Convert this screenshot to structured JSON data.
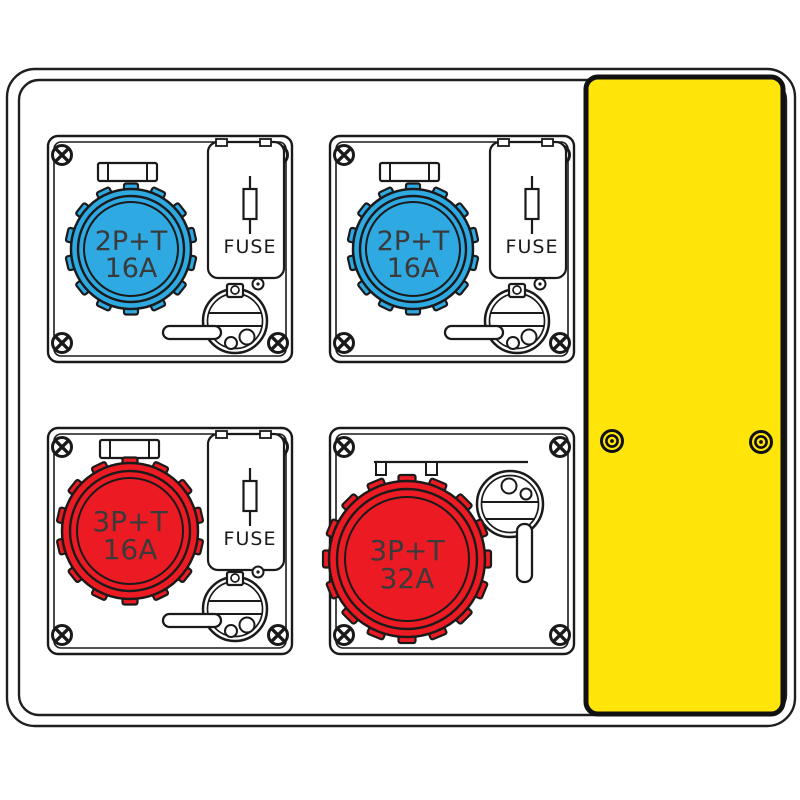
{
  "board": {
    "description": "distribution-board-technical-drawing",
    "line_color": "#1a1a1a",
    "label_color": "#3a3a3a",
    "side_panel": {
      "color": "#ffe50a",
      "fastener_icon": "concentric-rivet",
      "fastener_count": 2
    }
  },
  "modules": [
    {
      "position": "top-left",
      "socket": {
        "line1": "2P+T",
        "line2": "16A",
        "color": "#2fa9e1",
        "icon": "cee-socket-blue-16a"
      },
      "fuse_label": "FUSE",
      "has_interlock": true
    },
    {
      "position": "top-right",
      "socket": {
        "line1": "2P+T",
        "line2": "16A",
        "color": "#2fa9e1",
        "icon": "cee-socket-blue-16a"
      },
      "fuse_label": "FUSE",
      "has_interlock": true
    },
    {
      "position": "bottom-left",
      "socket": {
        "line1": "3P+T",
        "line2": "16A",
        "color": "#ec1b23",
        "icon": "cee-socket-red-16a"
      },
      "fuse_label": "FUSE",
      "has_interlock": true
    },
    {
      "position": "bottom-right",
      "socket": {
        "line1": "3P+T",
        "line2": "32A",
        "color": "#ec1b23",
        "icon": "cee-socket-red-32a"
      },
      "has_interlock": true
    }
  ]
}
